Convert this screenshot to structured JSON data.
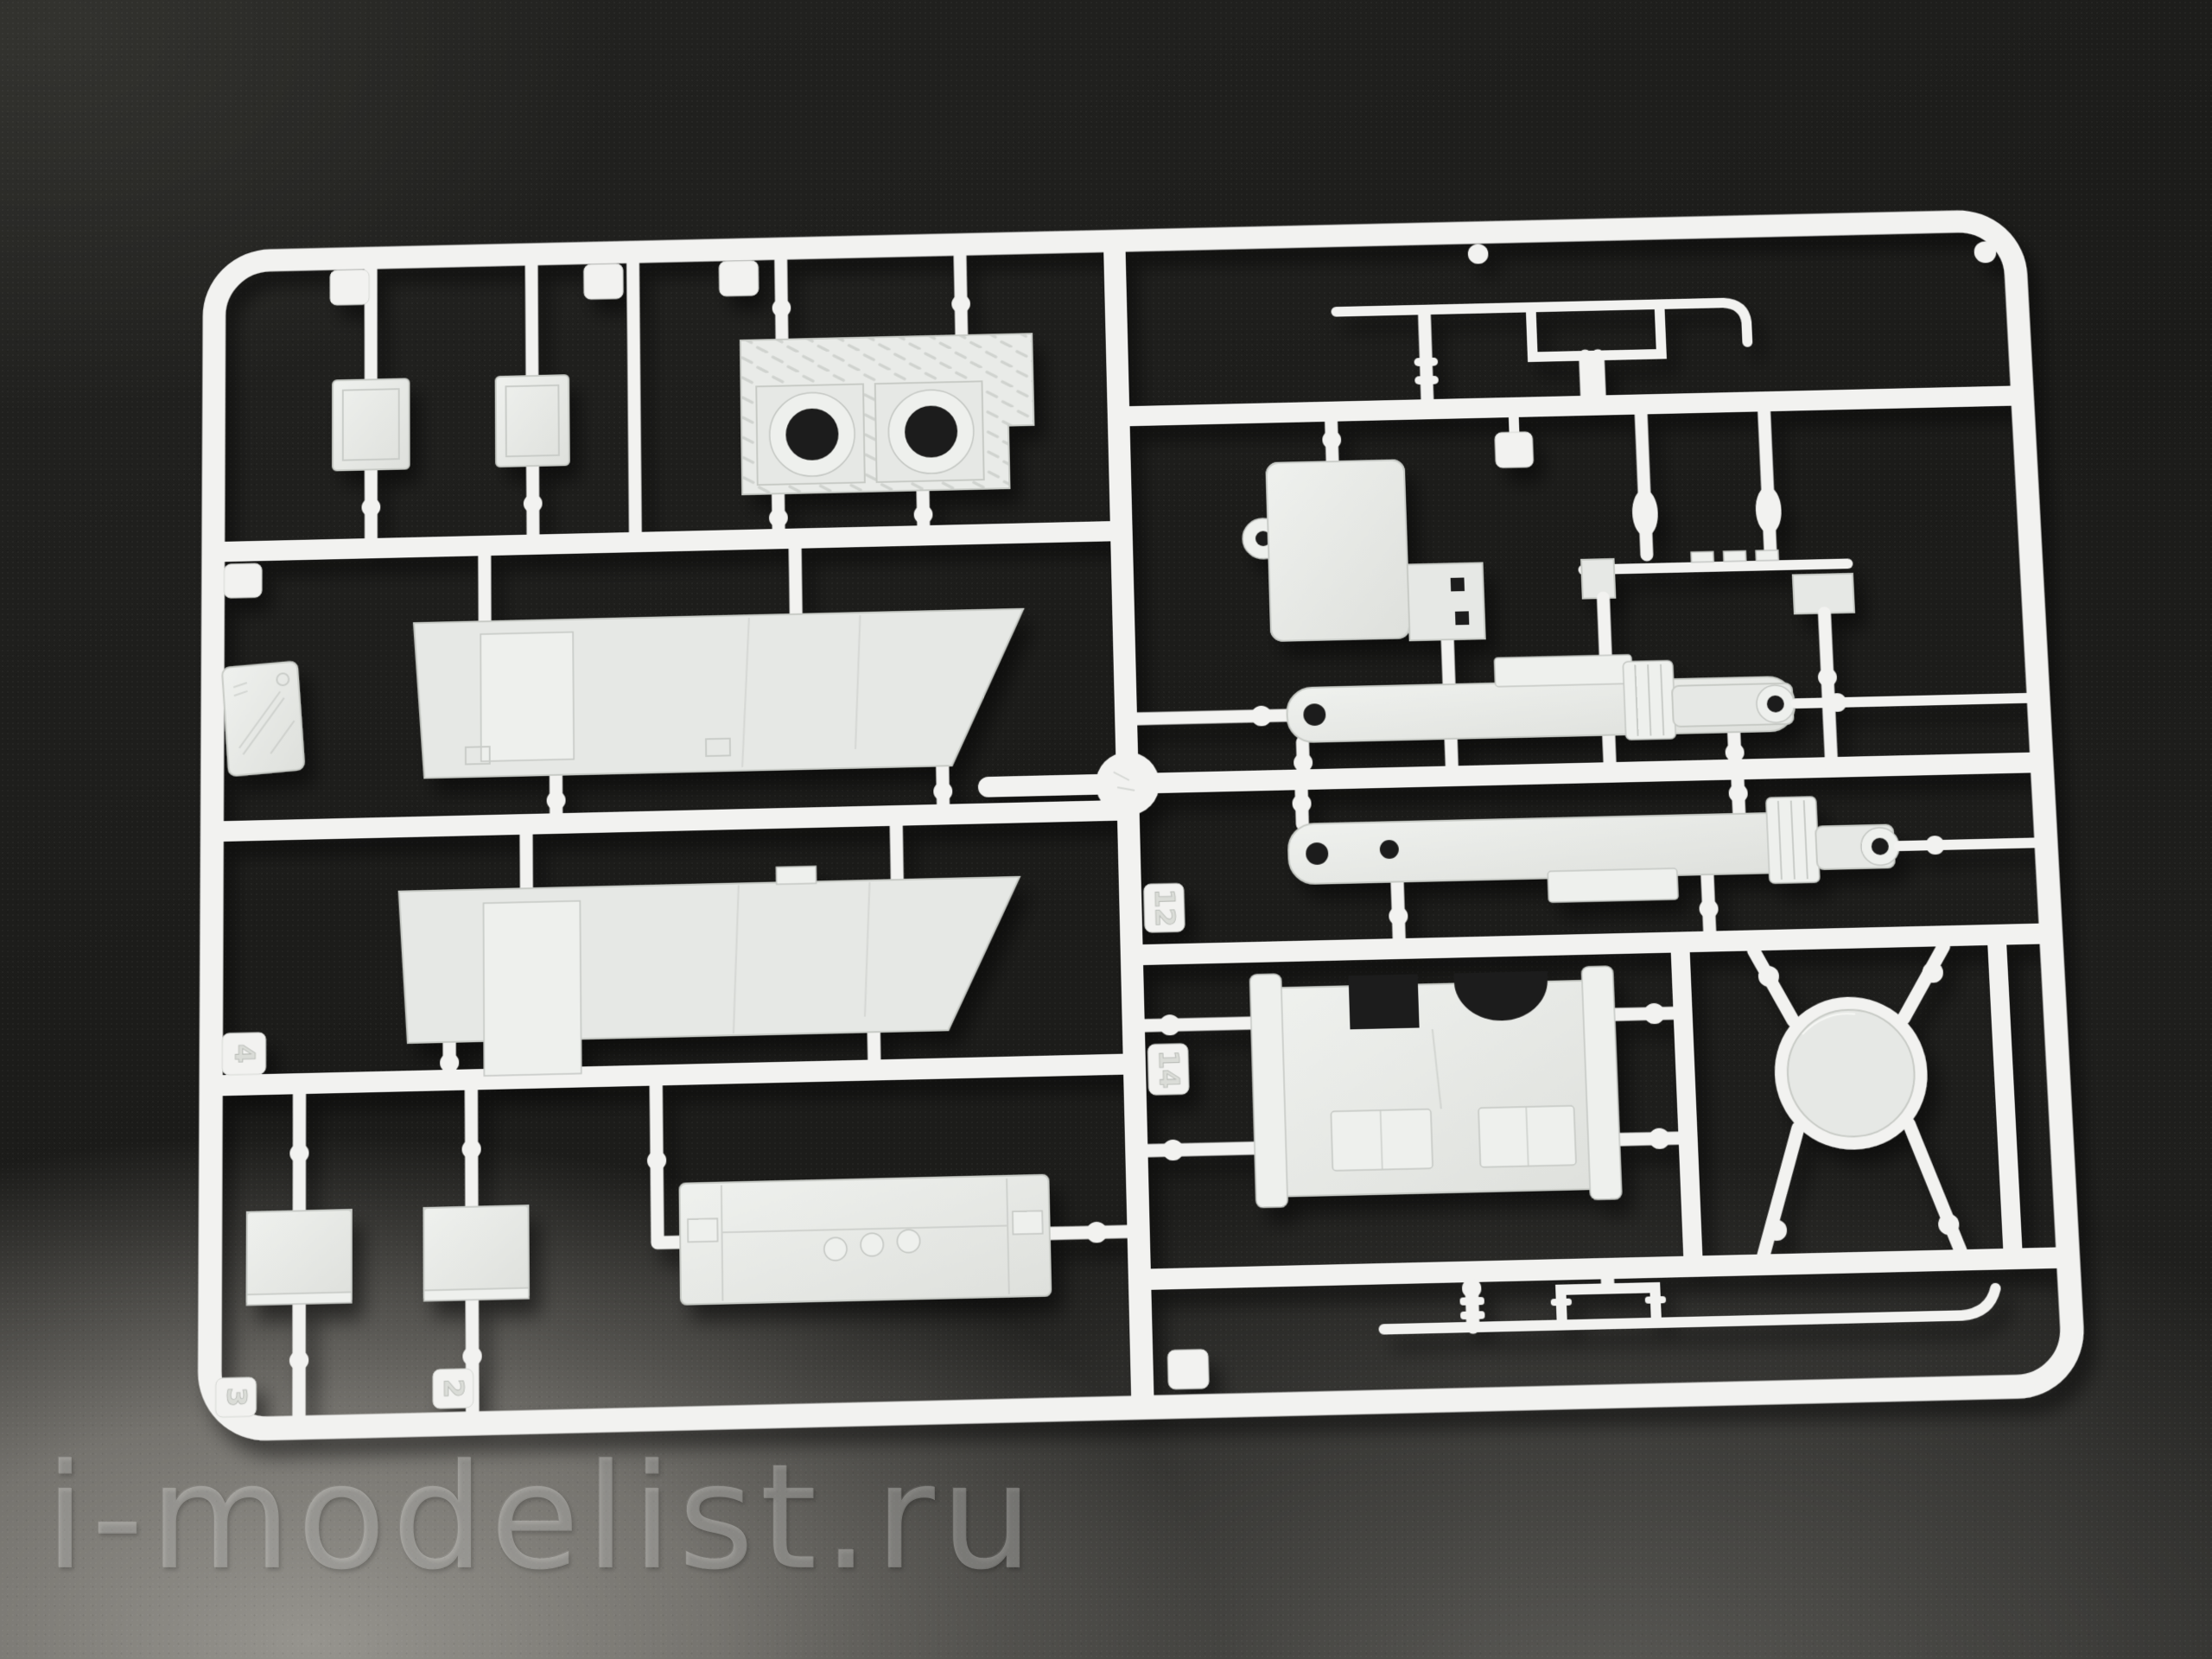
{
  "watermark": {
    "text": "i-modelist.ru"
  },
  "palette": {
    "background": "#1e1e1c",
    "surface_light": "#8b8a86",
    "plastic": "#f2f2f0",
    "part_face": "#e6e8e5",
    "part_shade": "#dfe1dd",
    "hole_dark": "#1f1f1d",
    "watermark": "rgba(244,244,239,0.26)"
  },
  "sprue": {
    "molded_part_numbers": {
      "t2": "2",
      "t3": "3",
      "t4": "4",
      "t12": "12",
      "t14": "14"
    },
    "parts": [
      {
        "name": "square-hatch-1"
      },
      {
        "name": "square-hatch-2"
      },
      {
        "name": "checkerplate-mount-two-holes"
      },
      {
        "name": "hull-side-panel-upper"
      },
      {
        "name": "hull-side-panel-lower"
      },
      {
        "name": "louver-grille-1"
      },
      {
        "name": "louver-grille-2"
      },
      {
        "name": "cab-back-panel"
      },
      {
        "name": "grab-rail-top"
      },
      {
        "name": "tread-plate-dotted"
      },
      {
        "name": "mounting-rail"
      },
      {
        "name": "outrigger-beam-upper"
      },
      {
        "name": "outrigger-beam-lower"
      },
      {
        "name": "cab-floor-panel"
      },
      {
        "name": "round-hatch-disc"
      },
      {
        "name": "skid-rail-bottom"
      },
      {
        "name": "brand-plate"
      }
    ]
  }
}
